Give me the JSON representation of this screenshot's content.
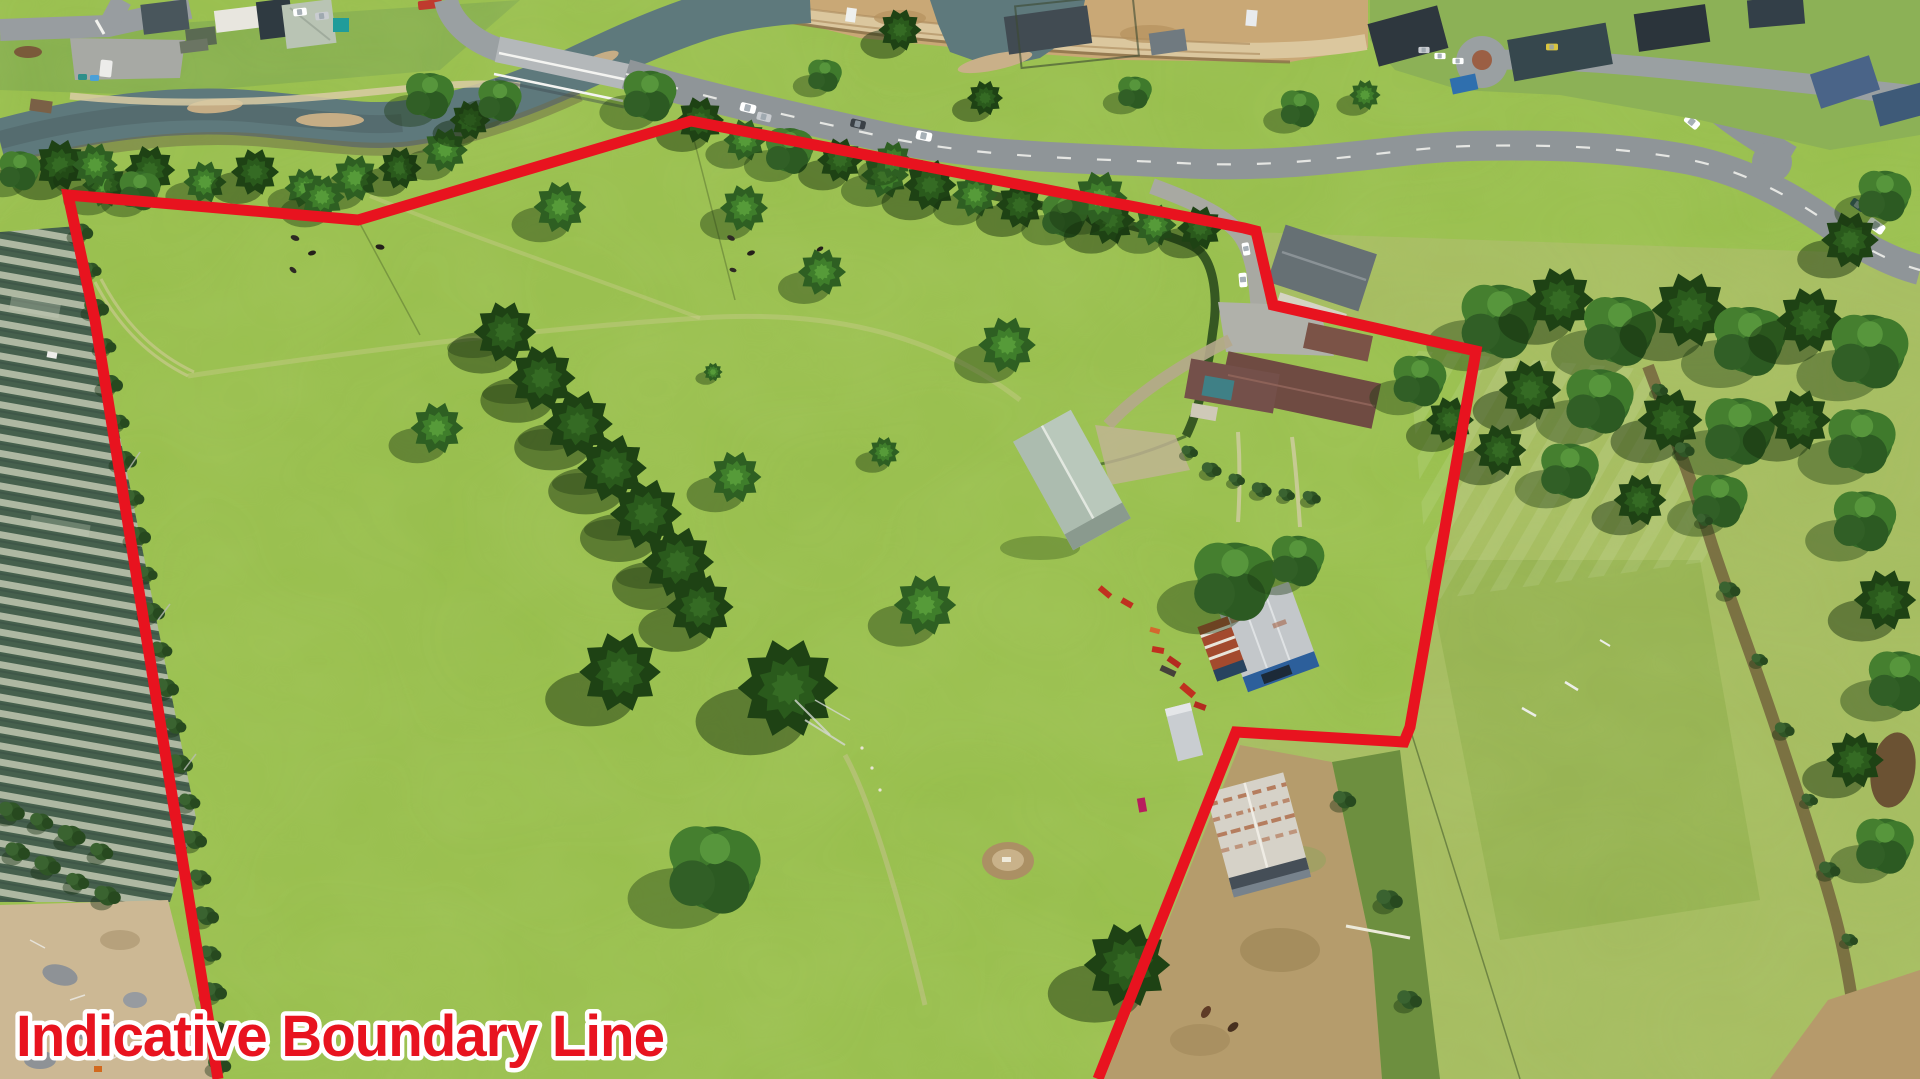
{
  "overlay": {
    "label": "Indicative Boundary Line",
    "label_x": "16",
    "label_y": "1056",
    "label_length": "648"
  },
  "boundary": {
    "points": "218,1079 95,320 68,195 358,220 691,121 1244,228 1256,231 1273,305 1476,351 1410,727 1404,742 1236,732 1098,1079",
    "stroke_width": "11"
  },
  "colors": {
    "boundary_red": "#e8131f",
    "label_fill": "#e8131f",
    "label_outline": "#ffffff",
    "pasture_green": "#95bd4a",
    "river_water": "#5e797c",
    "road_gray": "#8f9598",
    "dirt_tan": "#c9a876",
    "shed_green_roof": "#b9c8bb",
    "shed_blue": "#2c5f9b",
    "house_brown_roof": "#6f4b42"
  }
}
